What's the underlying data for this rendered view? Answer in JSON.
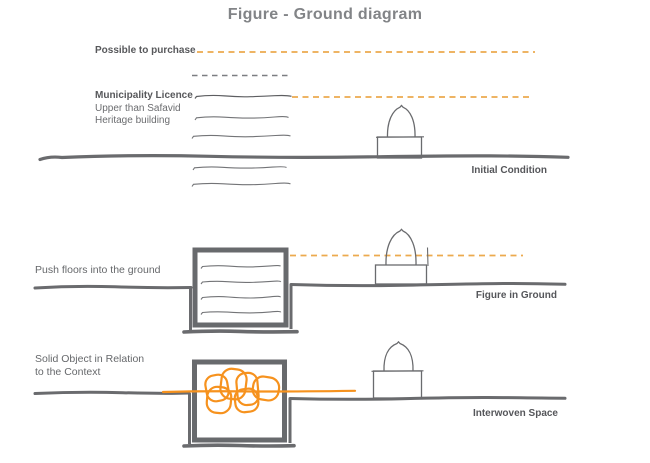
{
  "title": "Figure - Ground diagram",
  "colors": {
    "ink": "#6a6b6e",
    "text_dark": "#57585b",
    "text_regular": "#6b6c6f",
    "orange_accent": "#f6921e",
    "orange_dashed": "#ecaa4e",
    "gray_dashed": "#7c7e81"
  },
  "row1": {
    "label": "Initial Condition",
    "possible_line_label": "Possible to purchase",
    "municipality_line_label": "Municipality Licence",
    "municipality_sub1": "Upper than Safavid",
    "municipality_sub2": "Heritage building"
  },
  "row2": {
    "label": "Figure in Ground",
    "annotation": "Push floors into the ground"
  },
  "row3": {
    "label": "Interwoven Space",
    "annotation_line1": "Solid Object in Relation",
    "annotation_line2": "to the Context"
  }
}
